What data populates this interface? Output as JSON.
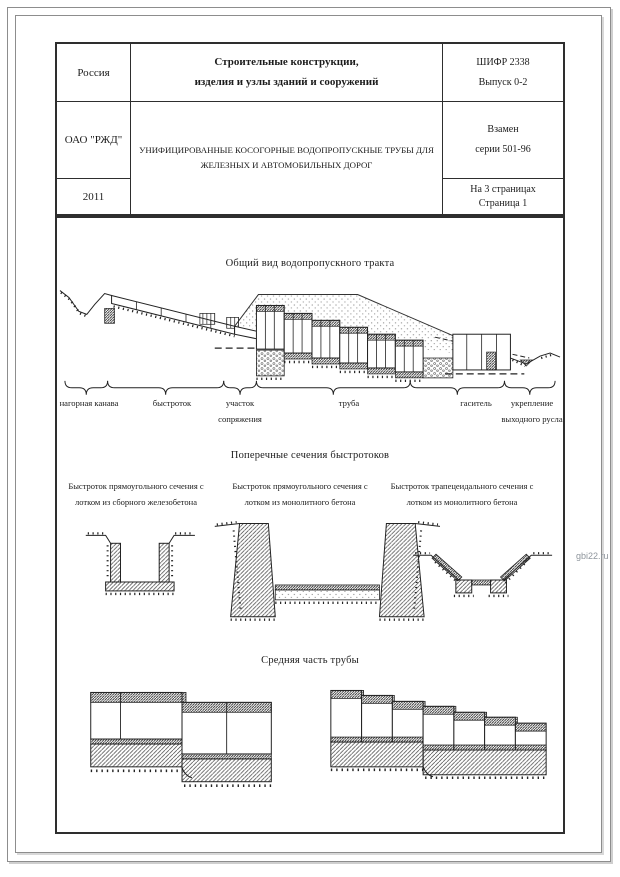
{
  "page": {
    "watermark": "gbi22.ru"
  },
  "title_block": {
    "country": "Россия",
    "organization": "ОАО \"РЖД\"",
    "year": "2011",
    "category": {
      "line1": "Строительные конструкции,",
      "line2": "изделия и узлы зданий и сооружений"
    },
    "subject": "УНИФИЦИРОВАННЫЕ КОСОГОРНЫЕ ВОДОПРОПУСКНЫЕ ТРУБЫ ДЛЯ ЖЕЛЕЗНЫХ И АВТОМОБИЛЬНЫХ ДОРОГ",
    "code": {
      "line1": "ШИФР 2338",
      "line2": "Выпуск 0-2"
    },
    "replaces": {
      "line1": "Взамен",
      "line2": "серии 501-96"
    },
    "pages": {
      "line1": "На 3 страницах",
      "line2": "Страница 1"
    }
  },
  "sections": {
    "general_view": {
      "title": "Общий вид водопропускного тракта",
      "labels": [
        "нагорная канава",
        "быстроток",
        "участок сопряжения",
        "труба",
        "гаситель",
        "укрепление выходного русла"
      ]
    },
    "cross_sections": {
      "title": "Поперечные сечения быстротоков",
      "captions": [
        "Быстроток прямоугольного сечения с лотком из сборного железобетона",
        "Быстроток прямоугольного сечения с лотком из монолитного бетона",
        "Быстроток трапецеидального сечения с лотком из монолитного бетона"
      ]
    },
    "middle_part": {
      "title": "Средняя часть трубы"
    }
  }
}
